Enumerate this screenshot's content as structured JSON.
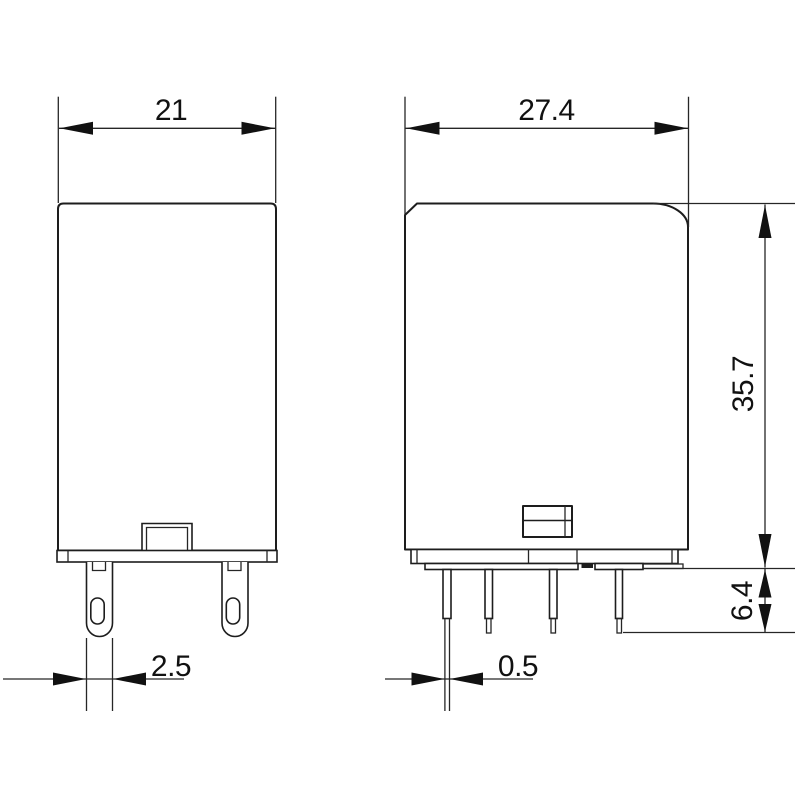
{
  "drawing": {
    "type": "technical-dimension-drawing",
    "background": "#ffffff",
    "line_color": "#1d1d1d",
    "views": {
      "side_view": {
        "dimensions": {
          "width": "21",
          "pin_width": "2.5"
        }
      },
      "front_view": {
        "dimensions": {
          "width": "27.4",
          "body_height": "35.7",
          "pin_length": "6.4",
          "pin_thickness": "0.5"
        }
      }
    }
  }
}
